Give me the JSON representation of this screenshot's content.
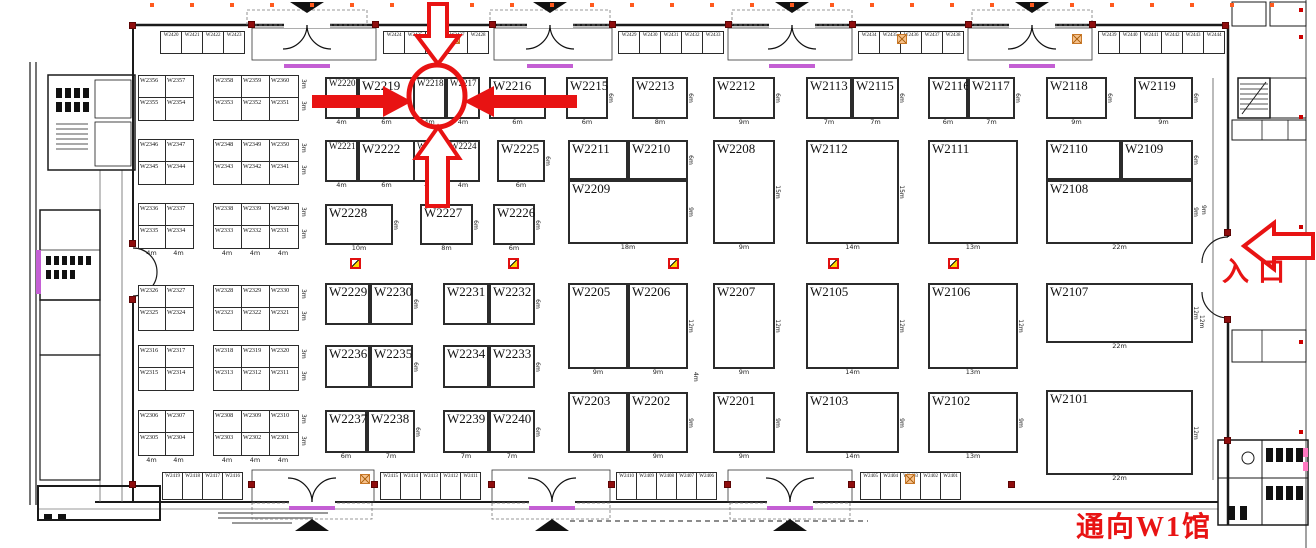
{
  "annotations": {
    "entrance": "入口",
    "to_w1": "通向W1馆",
    "circled_booth": "W2218",
    "annotation_red": "#e81313"
  },
  "colors": {
    "booth_border": "#2b2b2b",
    "purple_accent": "#c45fd4",
    "marker_red": "#cc0000",
    "marker_orange": "#ff5a1e",
    "fire_yellow": "#ffd800"
  },
  "main_booths": [
    {
      "id": "W2220",
      "x": 325,
      "y": 77,
      "w": 33,
      "h": 42,
      "bl": "4m"
    },
    {
      "id": "W2219",
      "x": 358,
      "y": 77,
      "w": 57,
      "h": 42,
      "bl": "6m",
      "sl": "6m"
    },
    {
      "id": "W2218",
      "x": 413,
      "y": 77,
      "w": 33,
      "h": 42,
      "bl": "4m"
    },
    {
      "id": "W2217",
      "x": 446,
      "y": 77,
      "w": 34,
      "h": 42,
      "bl": "4m"
    },
    {
      "id": "W2216",
      "x": 489,
      "y": 77,
      "w": 57,
      "h": 42,
      "bl": "6m"
    },
    {
      "id": "W2215",
      "x": 566,
      "y": 77,
      "w": 42,
      "h": 42,
      "bl": "6m",
      "sl": "6m"
    },
    {
      "id": "W2213",
      "x": 632,
      "y": 77,
      "w": 56,
      "h": 42,
      "bl": "8m",
      "sl": "6m"
    },
    {
      "id": "W2212",
      "x": 713,
      "y": 77,
      "w": 62,
      "h": 42,
      "bl": "9m",
      "sl": "6m"
    },
    {
      "id": "W2113",
      "x": 806,
      "y": 77,
      "w": 46,
      "h": 42,
      "bl": "7m"
    },
    {
      "id": "W2115",
      "x": 852,
      "y": 77,
      "w": 47,
      "h": 42,
      "bl": "7m",
      "sl": "6m"
    },
    {
      "id": "W2116",
      "x": 928,
      "y": 77,
      "w": 40,
      "h": 42,
      "bl": "6m"
    },
    {
      "id": "W2117",
      "x": 968,
      "y": 77,
      "w": 47,
      "h": 42,
      "bl": "7m",
      "sl": "6m"
    },
    {
      "id": "W2118",
      "x": 1046,
      "y": 77,
      "w": 61,
      "h": 42,
      "bl": "9m",
      "sl": "6m"
    },
    {
      "id": "W2119",
      "x": 1134,
      "y": 77,
      "w": 59,
      "h": 42,
      "bl": "9m",
      "sl": "6m"
    },
    {
      "id": "W2221",
      "x": 325,
      "y": 140,
      "w": 33,
      "h": 42,
      "bl": "4m"
    },
    {
      "id": "W2222",
      "x": 358,
      "y": 140,
      "w": 57,
      "h": 42,
      "bl": "6m",
      "sl": "6m"
    },
    {
      "id": "W2223",
      "x": 413,
      "y": 140,
      "w": 33,
      "h": 42,
      "bl": "4m"
    },
    {
      "id": "W2224",
      "x": 446,
      "y": 140,
      "w": 34,
      "h": 42,
      "bl": "4m"
    },
    {
      "id": "W2225",
      "x": 497,
      "y": 140,
      "w": 48,
      "h": 42,
      "bl": "6m",
      "sl": "6m"
    },
    {
      "id": "W2211",
      "x": 568,
      "y": 140,
      "w": 60,
      "h": 40
    },
    {
      "id": "W2210",
      "x": 628,
      "y": 140,
      "w": 60,
      "h": 40,
      "sl": "6m"
    },
    {
      "id": "W2209",
      "x": 568,
      "y": 180,
      "w": 120,
      "h": 64,
      "bl": "18m",
      "sl": "9m"
    },
    {
      "id": "W2208",
      "x": 713,
      "y": 140,
      "w": 62,
      "h": 104,
      "bl": "9m",
      "sl": "15m"
    },
    {
      "id": "W2112",
      "x": 806,
      "y": 140,
      "w": 93,
      "h": 104,
      "bl": "14m",
      "sl": "15m"
    },
    {
      "id": "W2111",
      "x": 928,
      "y": 140,
      "w": 90,
      "h": 104,
      "bl": "13m"
    },
    {
      "id": "W2110",
      "x": 1046,
      "y": 140,
      "w": 75,
      "h": 40
    },
    {
      "id": "W2109",
      "x": 1121,
      "y": 140,
      "w": 72,
      "h": 40,
      "sl": "6m"
    },
    {
      "id": "W2108",
      "x": 1046,
      "y": 180,
      "w": 147,
      "h": 64,
      "bl": "22m",
      "sl": "9m"
    },
    {
      "id": "W2228",
      "x": 325,
      "y": 204,
      "w": 68,
      "h": 41,
      "bl": "10m",
      "sl": "6m"
    },
    {
      "id": "W2227",
      "x": 420,
      "y": 204,
      "w": 53,
      "h": 41,
      "bl": "8m",
      "sl": "6m"
    },
    {
      "id": "W2226",
      "x": 493,
      "y": 204,
      "w": 42,
      "h": 41,
      "bl": "6m",
      "sl": "6m"
    },
    {
      "id": "W2229",
      "x": 325,
      "y": 283,
      "w": 45,
      "h": 42
    },
    {
      "id": "W2230",
      "x": 370,
      "y": 283,
      "w": 43,
      "h": 42,
      "sl": "6m"
    },
    {
      "id": "W2231",
      "x": 443,
      "y": 283,
      "w": 46,
      "h": 42
    },
    {
      "id": "W2232",
      "x": 489,
      "y": 283,
      "w": 46,
      "h": 42,
      "sl": "6m"
    },
    {
      "id": "W2205",
      "x": 568,
      "y": 283,
      "w": 60,
      "h": 86,
      "bl": "9m"
    },
    {
      "id": "W2206",
      "x": 628,
      "y": 283,
      "w": 60,
      "h": 86,
      "bl": "9m",
      "sl": "12m"
    },
    {
      "id": "W2207",
      "x": 713,
      "y": 283,
      "w": 62,
      "h": 86,
      "bl": "9m",
      "sl": "12m"
    },
    {
      "id": "W2105",
      "x": 806,
      "y": 283,
      "w": 93,
      "h": 86,
      "bl": "14m",
      "sl": "12m"
    },
    {
      "id": "W2106",
      "x": 928,
      "y": 283,
      "w": 90,
      "h": 86,
      "bl": "13m",
      "sl": "12m"
    },
    {
      "id": "W2107",
      "x": 1046,
      "y": 283,
      "w": 147,
      "h": 60,
      "bl": "22m",
      "sl": "12m"
    },
    {
      "id": "W2236",
      "x": 325,
      "y": 345,
      "w": 45,
      "h": 43
    },
    {
      "id": "W2235",
      "x": 370,
      "y": 345,
      "w": 43,
      "h": 43,
      "sl": "6m"
    },
    {
      "id": "W2234",
      "x": 443,
      "y": 345,
      "w": 46,
      "h": 43
    },
    {
      "id": "W2233",
      "x": 489,
      "y": 345,
      "w": 46,
      "h": 43,
      "sl": "6m"
    },
    {
      "id": "W2237",
      "x": 325,
      "y": 410,
      "w": 42,
      "h": 43,
      "bl": "6m"
    },
    {
      "id": "W2238",
      "x": 367,
      "y": 410,
      "w": 48,
      "h": 43,
      "bl": "7m",
      "sl": "6m"
    },
    {
      "id": "W2239",
      "x": 443,
      "y": 410,
      "w": 46,
      "h": 43,
      "bl": "7m"
    },
    {
      "id": "W2240",
      "x": 489,
      "y": 410,
      "w": 46,
      "h": 43,
      "bl": "7m",
      "sl": "6m"
    },
    {
      "id": "W2203",
      "x": 568,
      "y": 392,
      "w": 60,
      "h": 61,
      "bl": "9m"
    },
    {
      "id": "W2202",
      "x": 628,
      "y": 392,
      "w": 60,
      "h": 61,
      "bl": "9m",
      "sl": "9m"
    },
    {
      "id": "W2201",
      "x": 713,
      "y": 392,
      "w": 62,
      "h": 61,
      "bl": "9m",
      "sl": "9m"
    },
    {
      "id": "W2103",
      "x": 806,
      "y": 392,
      "w": 93,
      "h": 61,
      "bl": "14m",
      "sl": "9m"
    },
    {
      "id": "W2102",
      "x": 928,
      "y": 392,
      "w": 90,
      "h": 61,
      "bl": "13m",
      "sl": "9m"
    },
    {
      "id": "W2101",
      "x": 1046,
      "y": 390,
      "w": 147,
      "h": 85,
      "bl": "22m",
      "sl": "12m"
    }
  ],
  "left_blocks": [
    {
      "x": 138,
      "y": 75,
      "cw": 27,
      "rows": [
        [
          "W2356",
          "W2357"
        ],
        [
          "W2355",
          "W2354"
        ]
      ]
    },
    {
      "x": 213,
      "y": 75,
      "cw": 28,
      "rows": [
        [
          "W2358",
          "W2359",
          "W2360"
        ],
        [
          "W2353",
          "W2352",
          "W2351"
        ]
      ],
      "sls": [
        "3m",
        "3m"
      ]
    },
    {
      "x": 138,
      "y": 139,
      "cw": 27,
      "rows": [
        [
          "W2346",
          "W2347"
        ],
        [
          "W2345",
          "W2344"
        ]
      ]
    },
    {
      "x": 213,
      "y": 139,
      "cw": 28,
      "rows": [
        [
          "W2348",
          "W2349",
          "W2350"
        ],
        [
          "W2343",
          "W2342",
          "W2341"
        ]
      ],
      "sls": [
        "3m",
        "3m"
      ]
    },
    {
      "x": 138,
      "y": 203,
      "cw": 27,
      "rows": [
        [
          "W2336",
          "W2337"
        ],
        [
          "W2335",
          "W2334"
        ]
      ],
      "bls": [
        "4m",
        "4m"
      ]
    },
    {
      "x": 213,
      "y": 203,
      "cw": 28,
      "rows": [
        [
          "W2338",
          "W2339",
          "W2340"
        ],
        [
          "W2333",
          "W2332",
          "W2331"
        ]
      ],
      "bls": [
        "4m",
        "4m",
        "4m"
      ],
      "sls": [
        "3m",
        "3m"
      ]
    },
    {
      "x": 138,
      "y": 285,
      "cw": 27,
      "rows": [
        [
          "W2326",
          "W2327"
        ],
        [
          "W2325",
          "W2324"
        ]
      ]
    },
    {
      "x": 213,
      "y": 285,
      "cw": 28,
      "rows": [
        [
          "W2328",
          "W2329",
          "W2330"
        ],
        [
          "W2323",
          "W2322",
          "W2321"
        ]
      ],
      "sls": [
        "3m",
        "3m"
      ]
    },
    {
      "x": 138,
      "y": 345,
      "cw": 27,
      "rows": [
        [
          "W2316",
          "W2317"
        ],
        [
          "W2315",
          "W2314"
        ]
      ]
    },
    {
      "x": 213,
      "y": 345,
      "cw": 28,
      "rows": [
        [
          "W2318",
          "W2319",
          "W2320"
        ],
        [
          "W2313",
          "W2312",
          "W2311"
        ]
      ],
      "sls": [
        "3m",
        "3m"
      ]
    },
    {
      "x": 138,
      "y": 410,
      "cw": 27,
      "rows": [
        [
          "W2306",
          "W2307"
        ],
        [
          "W2305",
          "W2304"
        ]
      ],
      "bls": [
        "4m",
        "4m"
      ]
    },
    {
      "x": 213,
      "y": 410,
      "cw": 28,
      "rows": [
        [
          "W2308",
          "W2309",
          "W2310"
        ],
        [
          "W2303",
          "W2302",
          "W2301"
        ]
      ],
      "bls": [
        "4m",
        "4m",
        "4m"
      ],
      "sls": [
        "3m",
        "3m"
      ]
    }
  ],
  "top_strip": [
    {
      "x": 160,
      "cells": [
        "W2420",
        "W2421",
        "W2422",
        "W2423"
      ]
    },
    {
      "x": 383,
      "cells": [
        "W2424",
        "W2425",
        "W2426",
        "W2427",
        "W2428"
      ]
    },
    {
      "x": 618,
      "cells": [
        "W2429",
        "W2430",
        "W2431",
        "W2432",
        "W2433"
      ]
    },
    {
      "x": 858,
      "cells": [
        "W2434",
        "W2435",
        "W2436",
        "W2437",
        "W2438"
      ]
    },
    {
      "x": 1098,
      "cells": [
        "W2439",
        "W2440",
        "W2441",
        "W2442",
        "W2443",
        "W2444"
      ]
    }
  ],
  "bottom_strip": [
    {
      "x": 162,
      "cells": [
        "W2419",
        "W2418",
        "W2417",
        "W2416"
      ]
    },
    {
      "x": 380,
      "cells": [
        "W2415",
        "W2414",
        "W2413",
        "W2412",
        "W2411"
      ]
    },
    {
      "x": 616,
      "cells": [
        "W2410",
        "W2409",
        "W2408",
        "W2407",
        "W2406"
      ]
    },
    {
      "x": 860,
      "cells": [
        "W2405",
        "W2404",
        "W2403",
        "W2402",
        "W2401"
      ]
    }
  ],
  "dim_labels": [
    {
      "t": "4m",
      "x": 692,
      "y": 372,
      "rot": true
    },
    {
      "t": "9m",
      "x": 1200,
      "y": 205,
      "rot": true
    },
    {
      "t": "12m",
      "x": 1198,
      "y": 315,
      "rot": true
    }
  ],
  "fire_markers": [
    {
      "x": 350,
      "y": 258
    },
    {
      "x": 508,
      "y": 258
    },
    {
      "x": 668,
      "y": 258
    },
    {
      "x": 828,
      "y": 258
    },
    {
      "x": 948,
      "y": 258
    }
  ],
  "orange_boxes": [
    {
      "x": 450,
      "y": 34
    },
    {
      "x": 897,
      "y": 34
    },
    {
      "x": 1072,
      "y": 34
    },
    {
      "x": 360,
      "y": 474
    },
    {
      "x": 905,
      "y": 474
    }
  ],
  "wall_posts": [
    {
      "x": 248,
      "y": 21
    },
    {
      "x": 372,
      "y": 21
    },
    {
      "x": 489,
      "y": 21
    },
    {
      "x": 609,
      "y": 21
    },
    {
      "x": 725,
      "y": 21
    },
    {
      "x": 849,
      "y": 21
    },
    {
      "x": 965,
      "y": 21
    },
    {
      "x": 1089,
      "y": 21
    },
    {
      "x": 129,
      "y": 22
    },
    {
      "x": 1222,
      "y": 22
    },
    {
      "x": 248,
      "y": 481
    },
    {
      "x": 371,
      "y": 481
    },
    {
      "x": 488,
      "y": 481
    },
    {
      "x": 608,
      "y": 481
    },
    {
      "x": 724,
      "y": 481
    },
    {
      "x": 848,
      "y": 481
    },
    {
      "x": 1008,
      "y": 481
    },
    {
      "x": 129,
      "y": 481
    },
    {
      "x": 1224,
      "y": 229
    },
    {
      "x": 1224,
      "y": 316
    },
    {
      "x": 1224,
      "y": 437
    },
    {
      "x": 129,
      "y": 240
    },
    {
      "x": 129,
      "y": 296
    }
  ],
  "red_dots_right": [
    {
      "x": 1299,
      "y": 8
    },
    {
      "x": 1299,
      "y": 35
    },
    {
      "x": 1299,
      "y": 115
    },
    {
      "x": 1299,
      "y": 225
    },
    {
      "x": 1299,
      "y": 340
    },
    {
      "x": 1299,
      "y": 430
    }
  ]
}
